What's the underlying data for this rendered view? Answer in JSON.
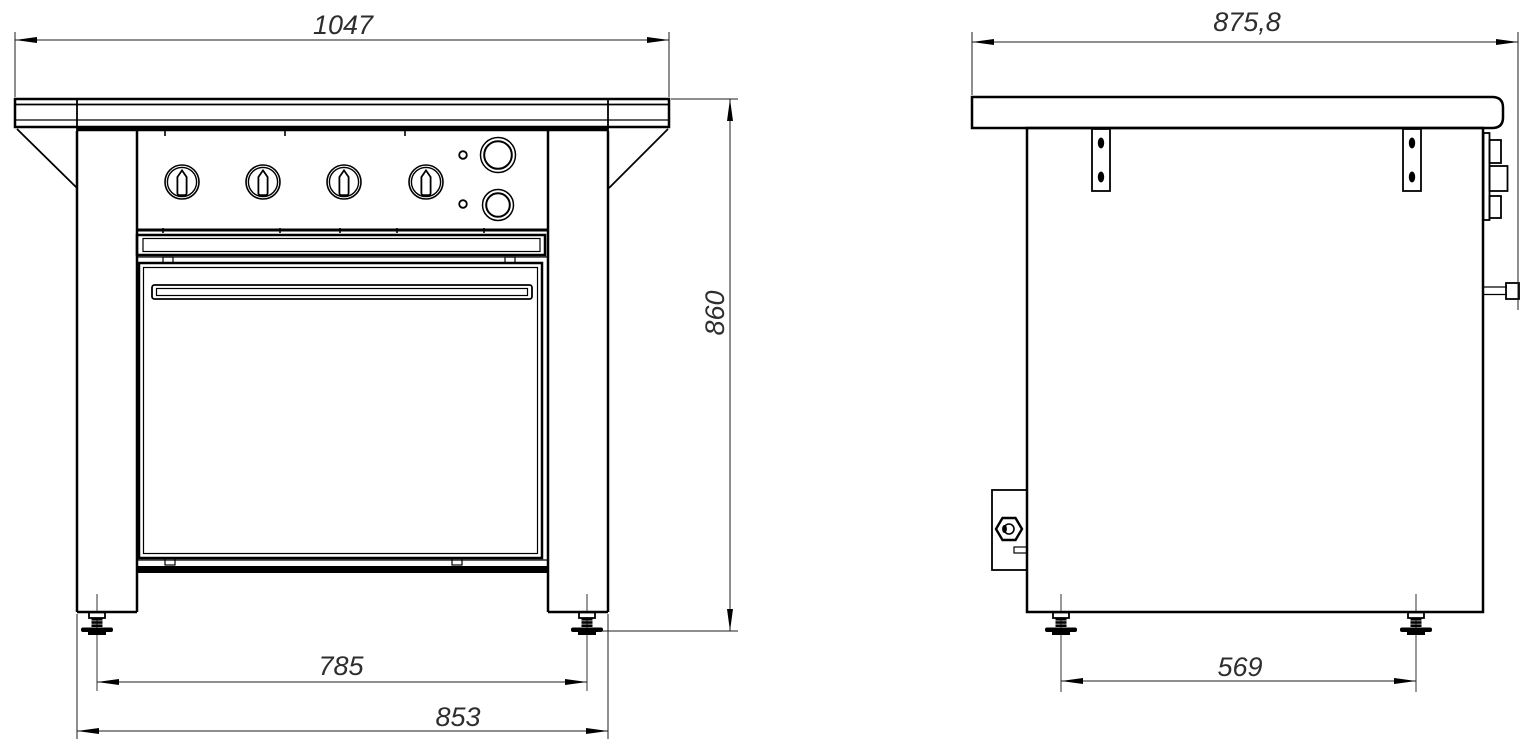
{
  "drawing_title": "range-with-oven-two-view-drawing",
  "colors": {
    "line": "#000000",
    "dimension_text": "#2e2e2e",
    "background": "#ffffff"
  },
  "front_view": {
    "overall_width": "1047",
    "overall_height": "860",
    "feet_spacing": "785",
    "base_width": "853"
  },
  "side_view": {
    "overall_depth": "875,8",
    "feet_spacing": "569"
  }
}
